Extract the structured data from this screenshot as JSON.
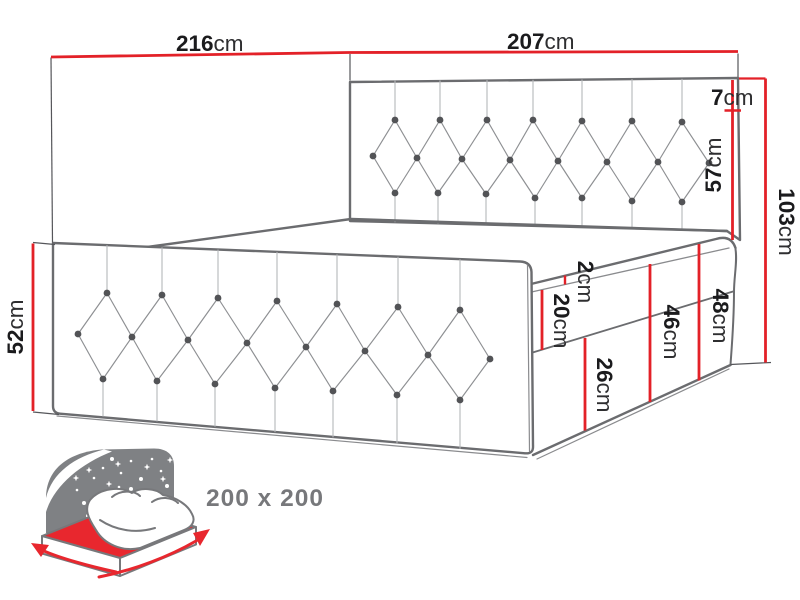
{
  "diagram": {
    "type": "bed-dimension-drawing",
    "dimensions": {
      "depth_total": {
        "value": "216",
        "unit": "cm"
      },
      "width_total": {
        "value": "207",
        "unit": "cm"
      },
      "headboard_border": {
        "value": "7",
        "unit": "cm"
      },
      "headboard_panel": {
        "value": "57",
        "unit": "cm"
      },
      "height_total": {
        "value": "103",
        "unit": "cm"
      },
      "side_height": {
        "value": "52",
        "unit": "cm"
      },
      "topper": {
        "value": "2",
        "unit": "cm"
      },
      "mattress": {
        "value": "20",
        "unit": "cm"
      },
      "base_box": {
        "value": "26",
        "unit": "cm"
      },
      "mattress_base": {
        "value": "46",
        "unit": "cm"
      },
      "mattress_base_topper": {
        "value": "48",
        "unit": "cm"
      }
    },
    "size_badge": {
      "label": "200 x 200"
    },
    "icon": {
      "name": "bed-size-icon"
    },
    "colors": {
      "dimension_red": "#e32128",
      "drawing_gray": "#6b6c6f",
      "icon_gray": "#7f8184",
      "text_dark": "#1b1b1d",
      "size_text_gray": "#77787b"
    }
  }
}
